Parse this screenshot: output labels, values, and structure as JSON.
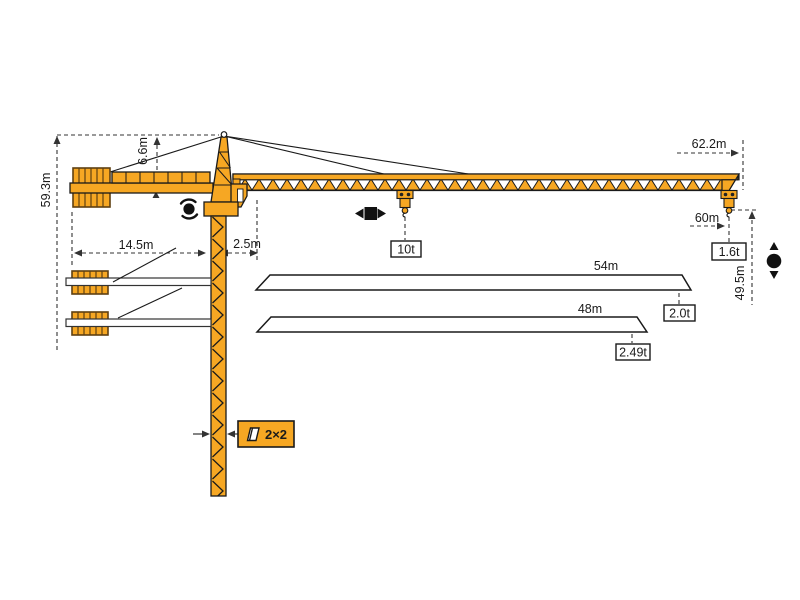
{
  "diagram": {
    "type": "tower-crane-load-diagram",
    "colors": {
      "crane_orange": "#F6A723",
      "ballast_border": "#5f4012",
      "outline": "#1a1a1a",
      "dimension_lines": "#333333",
      "background": "#ffffff"
    },
    "dimensions": {
      "total_height": "59.3m",
      "head_height": "6.6m",
      "counterjib_radius": "14.5m",
      "rear_clearance": "2.5m",
      "max_jib_radius": "62.2m",
      "max_hook_radius": "60m",
      "hook_height": "49.5m"
    },
    "mast": {
      "section_label": "2×2"
    },
    "loads": {
      "max_capacity": "10t",
      "tip_load_full": "1.6t"
    },
    "jib_options": [
      {
        "length": "54m",
        "tip_load": "2.0t"
      },
      {
        "length": "48m",
        "tip_load": "2.49t"
      }
    ],
    "icons": {
      "slewing": "rotation-icon",
      "trolley": "trolley-travel-icon",
      "hoist": "hoist-up-down-icon"
    }
  }
}
